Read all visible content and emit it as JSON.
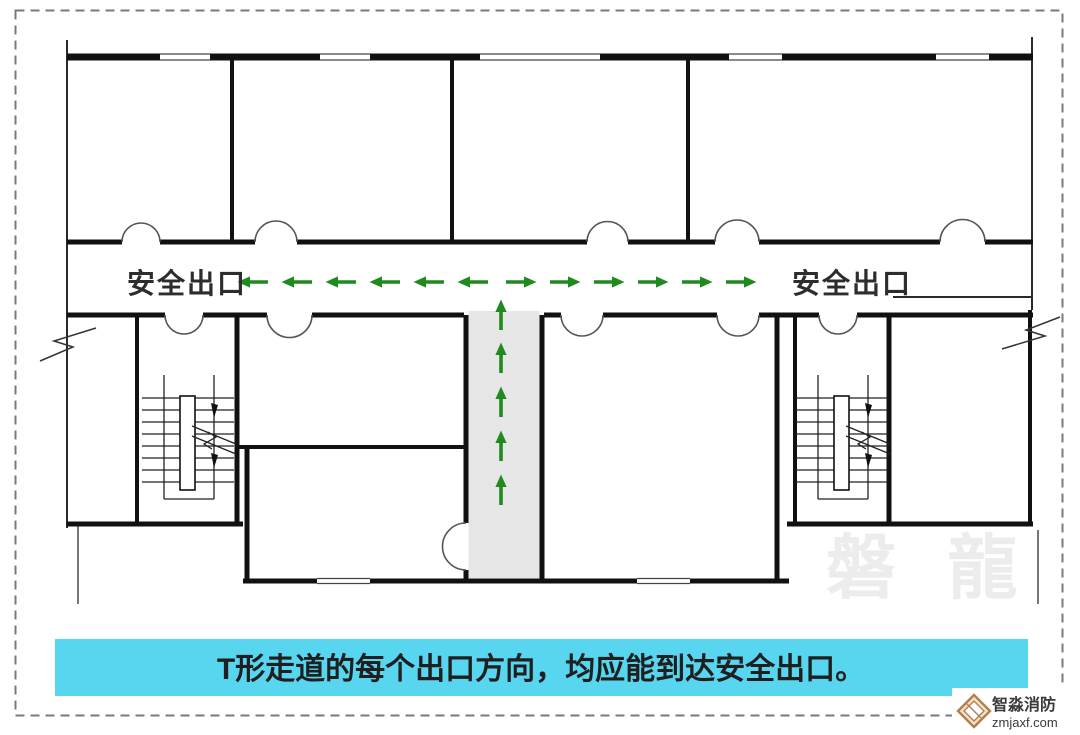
{
  "colors": {
    "wall": "#111111",
    "arrow_green": "#1f8b1f",
    "corridor_fill": "#e6e6e6",
    "caption_bg": "#58d5ef",
    "caption_text": "#1f1f1f",
    "watermark": "#ececec",
    "dashed_border": "#7a7a7a",
    "logo_accent": "#b08050"
  },
  "diagram": {
    "exit_label_left": "安全出口",
    "exit_label_right": "安全出口",
    "arrows": {
      "horizontal_left_count": 6,
      "horizontal_right_count": 6,
      "vertical_up_count": 5
    }
  },
  "caption": {
    "text": "T形走道的每个出口方向，均应能到达安全出口。"
  },
  "watermark": {
    "text": "磐 龍"
  },
  "logo": {
    "brand": "智淼消防",
    "site": "zmjaxf.com"
  }
}
